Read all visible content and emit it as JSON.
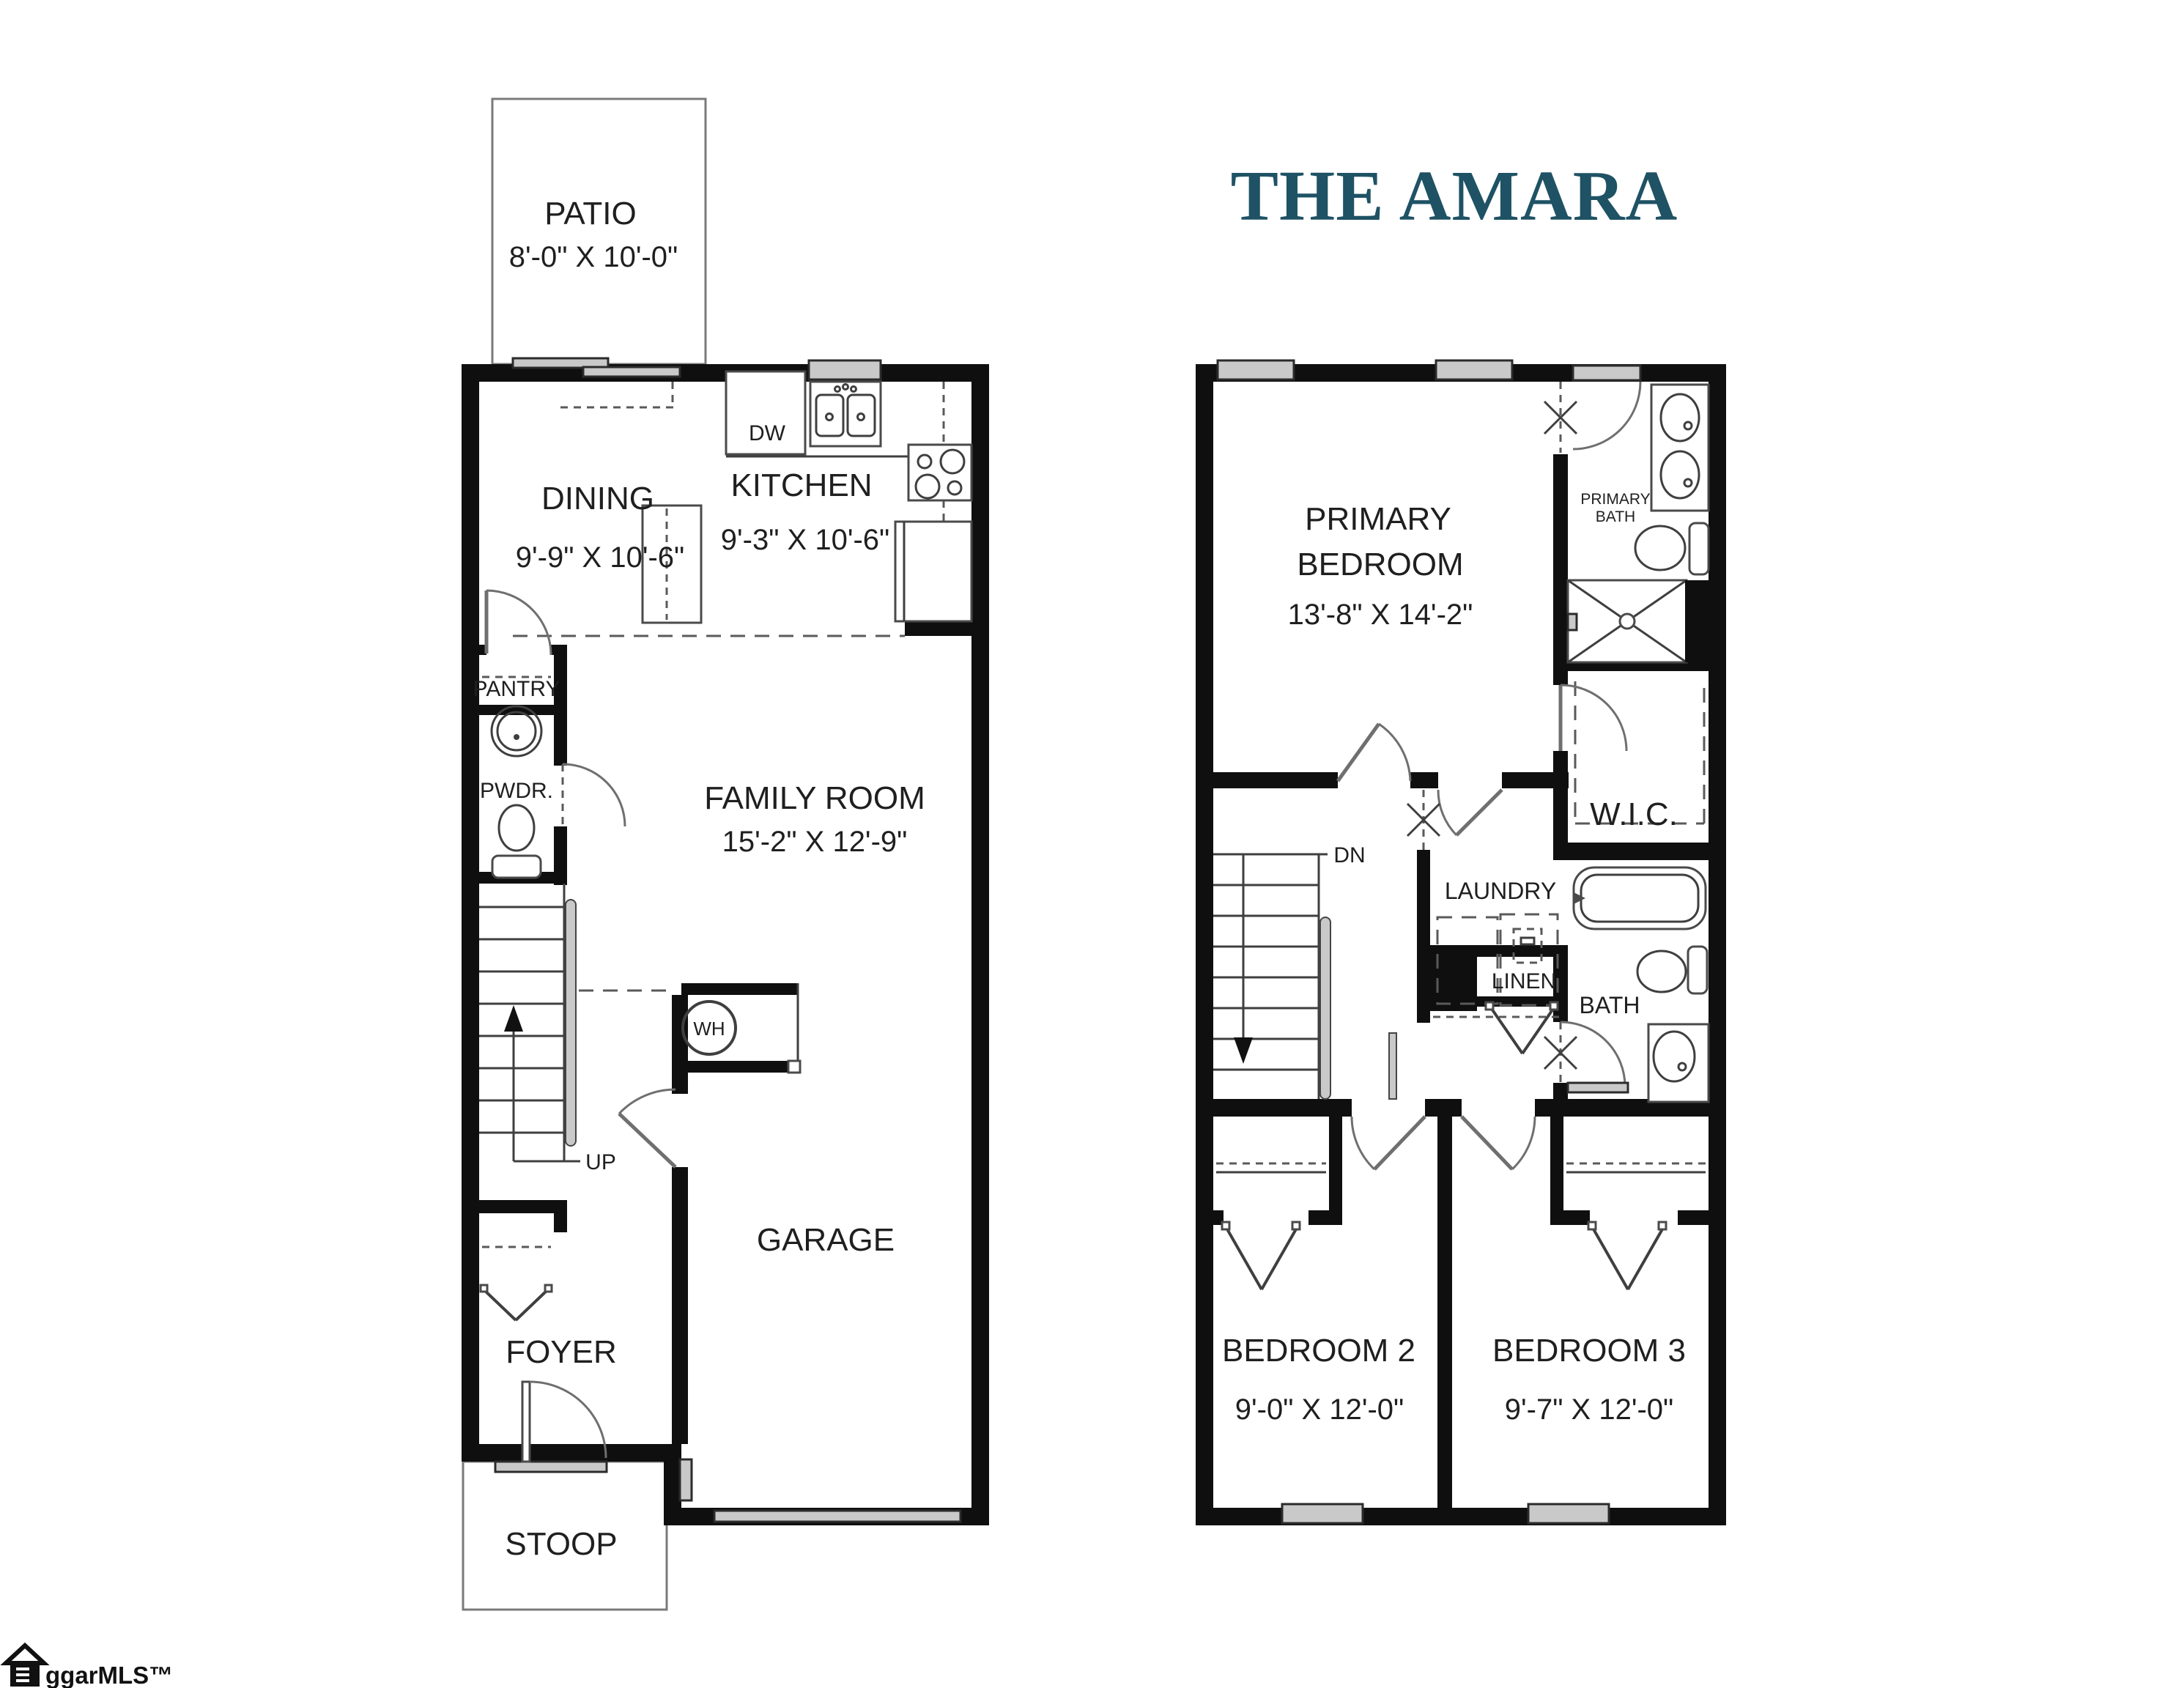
{
  "title": "THE AMARA",
  "watermark": "ggarMLS™",
  "colors": {
    "title": "#1e5264",
    "walls": "#0f0f0f",
    "labels": "#1f1f1f",
    "window_gray": "#c9c9c9"
  },
  "first_floor": {
    "patio": {
      "name": "PATIO",
      "dims": "8'-0\" X 10'-0\""
    },
    "dining": {
      "name": "DINING",
      "dims": "9'-9\" X 10'-6\""
    },
    "kitchen": {
      "name": "KITCHEN",
      "dims": "9'-3\" X 10'-6\""
    },
    "family_room": {
      "name": "FAMILY ROOM",
      "dims": "15'-2\" X 12'-9\""
    },
    "garage": {
      "name": "GARAGE"
    },
    "foyer": {
      "name": "FOYER"
    },
    "stoop": {
      "name": "STOOP"
    },
    "pantry": "PANTRY",
    "powder": "PWDR.",
    "dishwasher": "DW",
    "water_heater": "WH",
    "stairs_up": "UP"
  },
  "second_floor": {
    "primary_bedroom": {
      "name_line1": "PRIMARY",
      "name_line2": "BEDROOM",
      "dims": "13'-8\" X 14'-2\""
    },
    "primary_bath": {
      "line1": "PRIMARY",
      "line2": "BATH"
    },
    "wic": "W.I.C.",
    "laundry": "LAUNDRY",
    "linen": "LINEN",
    "bath": "BATH",
    "stairs_down": "DN",
    "bedroom2": {
      "name": "BEDROOM 2",
      "dims": "9'-0\" X 12'-0\""
    },
    "bedroom3": {
      "name": "BEDROOM 3",
      "dims": "9'-7\" X 12'-0\""
    }
  }
}
